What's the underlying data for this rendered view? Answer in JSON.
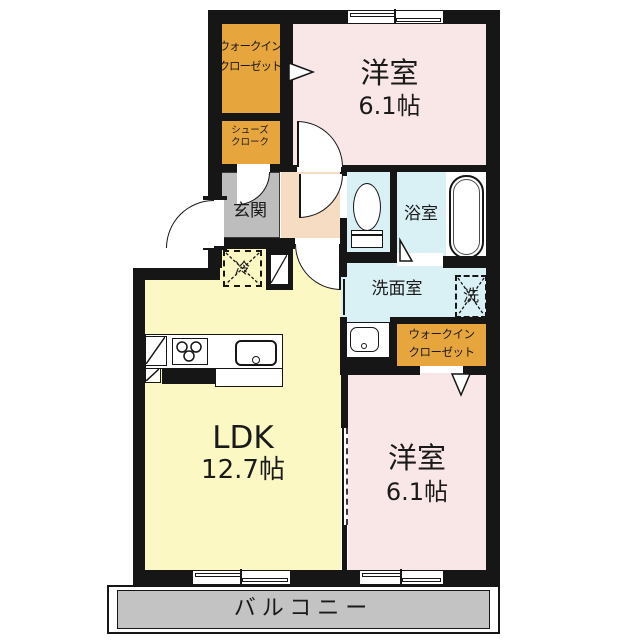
{
  "colors": {
    "wall": "#161616",
    "closet_orange": "#e7a53e",
    "room_pink": "#f9e7e7",
    "ldk_yellow": "#fbf8c4",
    "hall_peach": "#f5dcc2",
    "genkan_gray": "#bdbdbd",
    "wet_cyan": "#d9f1f5",
    "balcony_gray": "#c3c3c3",
    "fixture_white": "#ffffff"
  },
  "rooms": {
    "walk_in_closet_1": {
      "line1": "ウォークイン",
      "line2": "クローゼット"
    },
    "shoes_closet": {
      "line1": "シューズ",
      "line2": "クローク"
    },
    "bedroom_top": {
      "name": "洋室",
      "size": "6.1帖"
    },
    "entrance": {
      "name": "玄関"
    },
    "bathroom": {
      "name": "浴室"
    },
    "washroom": {
      "name": "洗面室"
    },
    "ldk": {
      "name": "LDK",
      "size": "12.7帖"
    },
    "walk_in_closet_2": {
      "line1": "ウォークイン",
      "line2": "クローゼット"
    },
    "bedroom_bottom": {
      "name": "洋室",
      "size": "6.1帖"
    },
    "balcony": {
      "name": "バルコニー"
    }
  },
  "symbols": {
    "washer": "洗",
    "fridge": "冷"
  }
}
